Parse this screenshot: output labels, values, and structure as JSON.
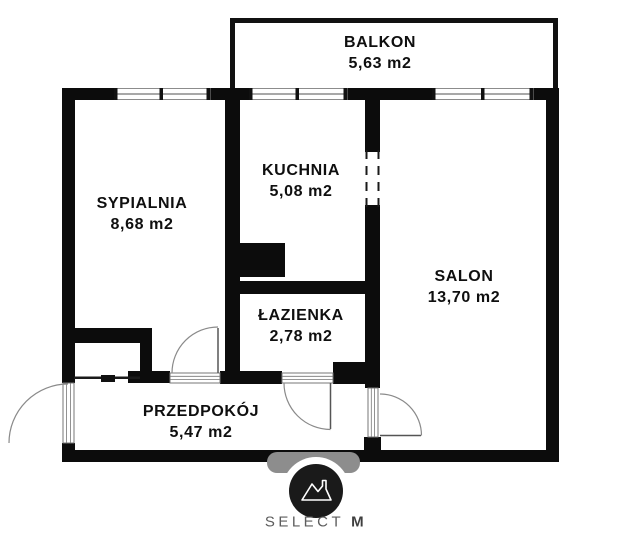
{
  "floorplan": {
    "rooms": {
      "balkon": {
        "name": "BALKON",
        "area": "5,63 m2"
      },
      "sypialnia": {
        "name": "SYPIALNIA",
        "area": "8,68 m2"
      },
      "kuchnia": {
        "name": "KUCHNIA",
        "area": "5,08 m2"
      },
      "salon": {
        "name": "SALON",
        "area": "13,70 m2"
      },
      "lazienka": {
        "name": "ŁAZIENKA",
        "area": "2,78 m2"
      },
      "przedpokoj": {
        "name": "PRZEDPOKÓJ",
        "area": "5,47 m2"
      }
    },
    "colors": {
      "wall": "#0c0c0c",
      "window_frame": "#8c8c8c",
      "door_arc": "#8a8a8a",
      "logo_circle": "#1a1a1a",
      "brand_text": "#5d5d5d"
    }
  },
  "branding": {
    "name": "SELECT",
    "suffix": "M",
    "icon": "mountain-icon"
  }
}
